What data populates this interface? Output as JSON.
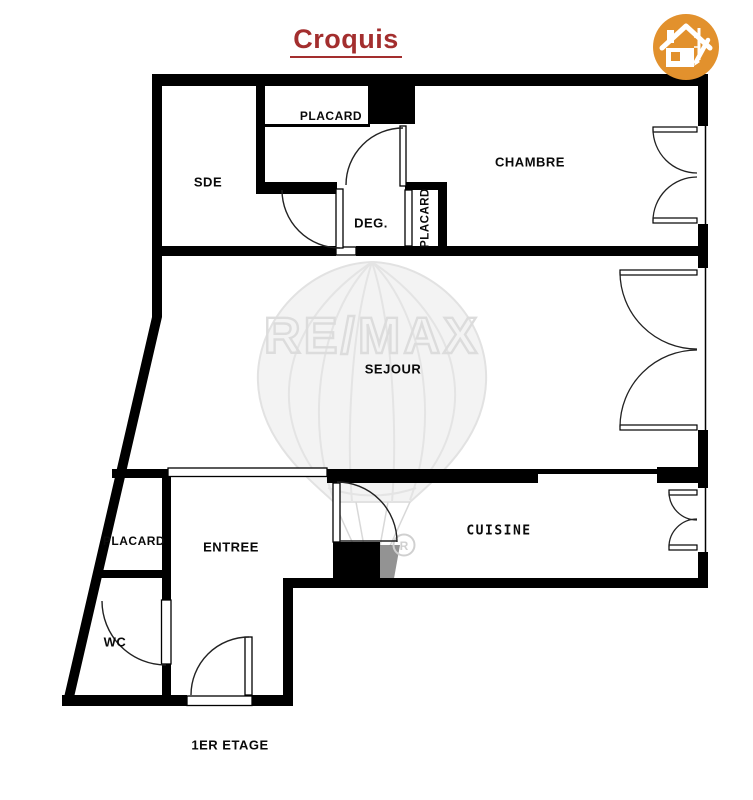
{
  "page": {
    "title": "Croquis",
    "floor_label": "1ER ETAGE"
  },
  "watermark": {
    "brand": "RE/MAX",
    "registered_symbol": "®"
  },
  "icons": {
    "logo": "house-sketch-icon"
  },
  "rooms": {
    "sde": "SDE",
    "placard_top": "PLACARD",
    "chambre": "CHAMBRE",
    "deg": "DEG.",
    "placard_chambre": "PLACARD",
    "sejour": "SEJOUR",
    "placard_entree": "PLACARD",
    "entree": "ENTREE",
    "wc": "WC",
    "cuisine": "CUISINE"
  },
  "colors": {
    "title_red": "#A32E2E",
    "logo_orange": "#E2912D",
    "wall_black": "#000000",
    "watermark_gray": "#DCDCDC"
  }
}
